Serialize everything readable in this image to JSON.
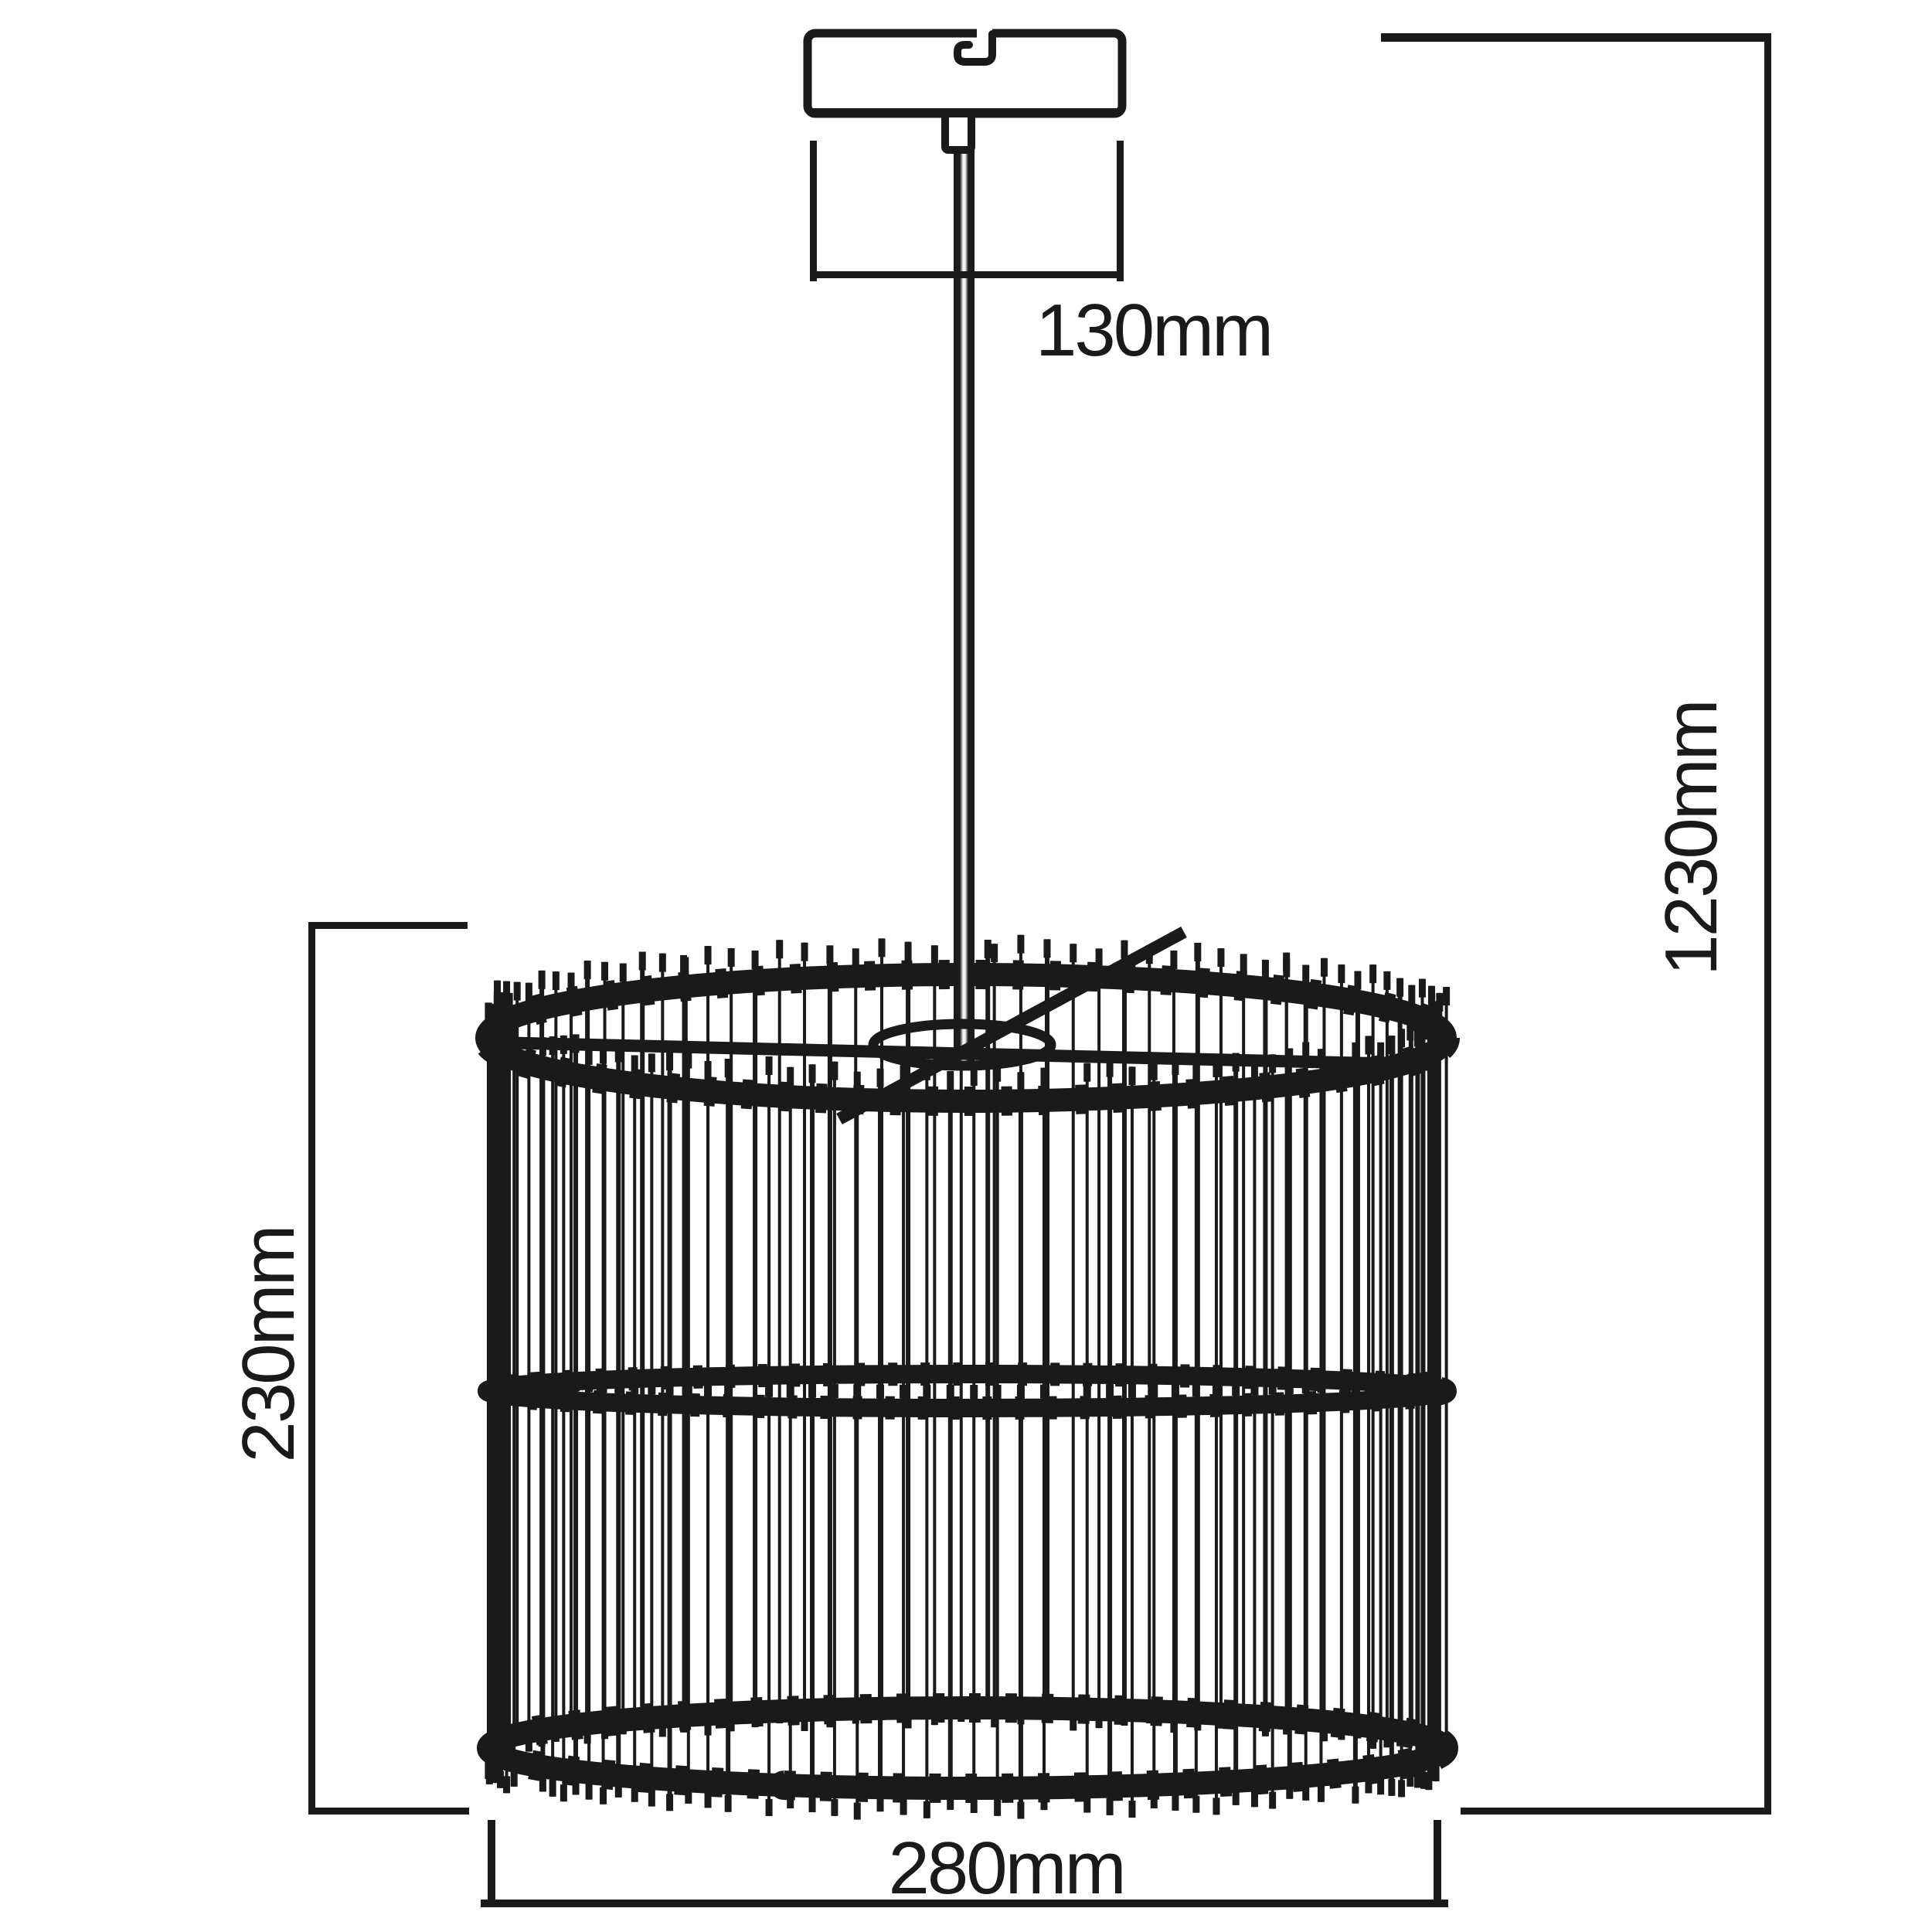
{
  "page": {
    "background": "#ffffff",
    "title": "Pendant lamp dimension drawing"
  },
  "colors": {
    "ink": "#1a1a1a",
    "rod_highlight": "#f2f2f2"
  },
  "diagram": {
    "type": "technical-dimension-drawing",
    "subject": "Ceiling pendant light with canopy, suspension rod and cylindrical slatted cage shade",
    "dimensions": {
      "canopy_width": {
        "label": "130mm"
      },
      "overall_height": {
        "label": "1230mm"
      },
      "shade_height": {
        "label": "230mm"
      },
      "shade_diameter": {
        "label": "280mm"
      }
    }
  }
}
